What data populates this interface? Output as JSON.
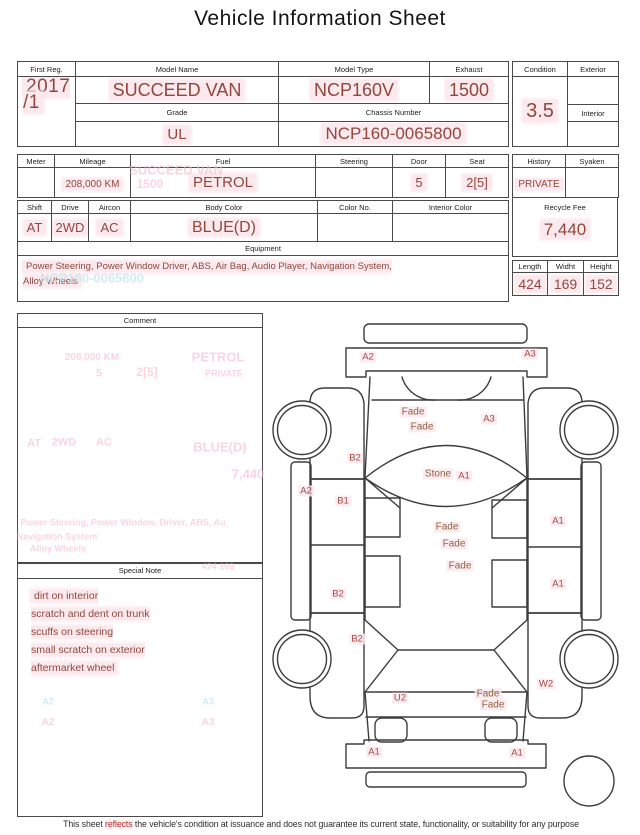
{
  "title": "Vehicle Information Sheet",
  "reg": {
    "first_reg_label": "First Reg.",
    "first_reg": "2017\n/1",
    "model_name_label": "Model Name",
    "model_name": "SUCCEED VAN",
    "model_type_label": "Model Type",
    "model_type": "NCP160V",
    "exhaust_label": "Exhaust",
    "exhaust": "1500",
    "grade_label": "Grade",
    "grade": "UL",
    "chassis_label": "Chassis Number",
    "chassis": "NCP160-0065800"
  },
  "condition": {
    "condition_label": "Condition",
    "score": "3.5",
    "exterior_label": "Exterior",
    "interior_label": "Interior"
  },
  "specs": {
    "meter_label": "Meter",
    "mileage_label": "Mileage",
    "mileage": "208,000 KM",
    "fuel_label": "Fuel",
    "fuel": "PETROL",
    "steering_label": "Steering",
    "door_label": "Door",
    "door": "5",
    "seat_label": "Seat",
    "seat": "2[5]",
    "shift_label": "Shift",
    "shift": "AT",
    "drive_label": "Drive",
    "drive": "2WD",
    "aircon_label": "Aircon",
    "aircon": "AC",
    "body_color_label": "Body Color",
    "body_color": "BLUE(D)",
    "color_no_label": "Color No.",
    "interior_color_label": "Interior Color"
  },
  "history": {
    "history_label": "History",
    "history": "PRIVATE",
    "syaken_label": "Syaken",
    "recycle_label": "Recycle Fee",
    "recycle_fee": "7,440",
    "length_label": "Length",
    "length": "424",
    "width_label": "Widht",
    "width": "169",
    "height_label": "Height",
    "height": "152"
  },
  "equipment": {
    "label": "Equipment",
    "text": "Power Steering, Power Window  Driver, ABS, Air Bag, Audio Player, Navigation System,\nAlloy Wheels"
  },
  "comment": {
    "label": "Comment"
  },
  "special_note": {
    "label": "Special Note",
    "text": "dirt on interior\nscratch and dent on trunk\nscuffs on steering\nsmall scratch on exterior\naftermarket wheel"
  },
  "diagram": {
    "labels": [
      {
        "t": "A2",
        "x": 368,
        "y": 357,
        "k": "code"
      },
      {
        "t": "A3",
        "x": 530,
        "y": 354,
        "k": "code"
      },
      {
        "t": "Fade",
        "x": 413,
        "y": 412,
        "k": "word"
      },
      {
        "t": "Fade",
        "x": 422,
        "y": 427,
        "k": "word"
      },
      {
        "t": "A3",
        "x": 489,
        "y": 419,
        "k": "code"
      },
      {
        "t": "B2",
        "x": 355,
        "y": 458,
        "k": "code"
      },
      {
        "t": "Stone",
        "x": 438,
        "y": 474,
        "k": "word"
      },
      {
        "t": "A1",
        "x": 464,
        "y": 476,
        "k": "code"
      },
      {
        "t": "A2",
        "x": 306,
        "y": 491,
        "k": "code"
      },
      {
        "t": "B1",
        "x": 343,
        "y": 501,
        "k": "code"
      },
      {
        "t": "A1",
        "x": 558,
        "y": 521,
        "k": "code"
      },
      {
        "t": "Fade",
        "x": 447,
        "y": 527,
        "k": "word"
      },
      {
        "t": "Fade",
        "x": 454,
        "y": 544,
        "k": "word"
      },
      {
        "t": "Fade",
        "x": 460,
        "y": 566,
        "k": "word"
      },
      {
        "t": "A1",
        "x": 558,
        "y": 584,
        "k": "code"
      },
      {
        "t": "B2",
        "x": 338,
        "y": 594,
        "k": "code"
      },
      {
        "t": "B2",
        "x": 357,
        "y": 639,
        "k": "code"
      },
      {
        "t": "W2",
        "x": 546,
        "y": 684,
        "k": "code"
      },
      {
        "t": "U2",
        "x": 400,
        "y": 698,
        "k": "code"
      },
      {
        "t": "Fade",
        "x": 488,
        "y": 694,
        "k": "word"
      },
      {
        "t": "Fade",
        "x": 493,
        "y": 705,
        "k": "word"
      },
      {
        "t": "A1",
        "x": 374,
        "y": 752,
        "k": "code"
      },
      {
        "t": "A1",
        "x": 517,
        "y": 753,
        "k": "code"
      }
    ]
  },
  "ghosts": [
    {
      "t": "SUCCEED VAN",
      "x": 176,
      "y": 170,
      "s": 13,
      "c": "pink"
    },
    {
      "t": "1500",
      "x": 150,
      "y": 184,
      "s": 12,
      "c": "pink"
    },
    {
      "t": "NCP160-0065800",
      "x": 92,
      "y": 278,
      "s": 13,
      "c": "cyan"
    },
    {
      "t": "208,000 KM",
      "x": 92,
      "y": 358,
      "s": 10,
      "c": "pink"
    },
    {
      "t": "PETROL",
      "x": 218,
      "y": 357,
      "s": 13,
      "c": "pink"
    },
    {
      "t": "5",
      "x": 99,
      "y": 374,
      "s": 11,
      "c": "pink"
    },
    {
      "t": "2[5]",
      "x": 147,
      "y": 372,
      "s": 12,
      "c": "pink"
    },
    {
      "t": "PRIVATE",
      "x": 224,
      "y": 374,
      "s": 9,
      "c": "pink"
    },
    {
      "t": "AT",
      "x": 34,
      "y": 444,
      "s": 11,
      "c": "pink"
    },
    {
      "t": "2WD",
      "x": 64,
      "y": 443,
      "s": 11,
      "c": "pink"
    },
    {
      "t": "AC",
      "x": 104,
      "y": 443,
      "s": 11,
      "c": "pink"
    },
    {
      "t": "BLUE(D)",
      "x": 220,
      "y": 447,
      "s": 13,
      "c": "pink"
    },
    {
      "t": "7,440",
      "x": 248,
      "y": 474,
      "s": 13,
      "c": "pink"
    },
    {
      "t": "Power Steering, Power Window, Driver, ABS, Au",
      "x": 123,
      "y": 523,
      "s": 9,
      "c": "pink"
    },
    {
      "t": "Navigation System",
      "x": 57,
      "y": 537,
      "s": 9,
      "c": "pink"
    },
    {
      "t": "Alloy Wheels",
      "x": 58,
      "y": 549,
      "s": 9,
      "c": "pink"
    },
    {
      "t": "424   169",
      "x": 218,
      "y": 567,
      "s": 9,
      "c": "pink"
    },
    {
      "t": "A2",
      "x": 48,
      "y": 702,
      "s": 9,
      "c": "cyan"
    },
    {
      "t": "A3",
      "x": 208,
      "y": 702,
      "s": 9,
      "c": "cyan"
    },
    {
      "t": "A2",
      "x": 48,
      "y": 723,
      "s": 10,
      "c": "pink"
    },
    {
      "t": "A3",
      "x": 208,
      "y": 723,
      "s": 10,
      "c": "pink"
    }
  ],
  "disclaimer": {
    "pre": "This sheet ",
    "emph": "reflects",
    "post": " the vehicle's condition at issuance and does not guarantee its current state, functionality, or suitability for any purpose"
  },
  "colors": {
    "value_red": "#91473e",
    "value_bg": "#fbe9ed",
    "label_code": "#a3493f",
    "label_word": "#8d6540",
    "ghost_pink": "#f5b5c5",
    "ghost_cyan": "#c9e9f2"
  }
}
